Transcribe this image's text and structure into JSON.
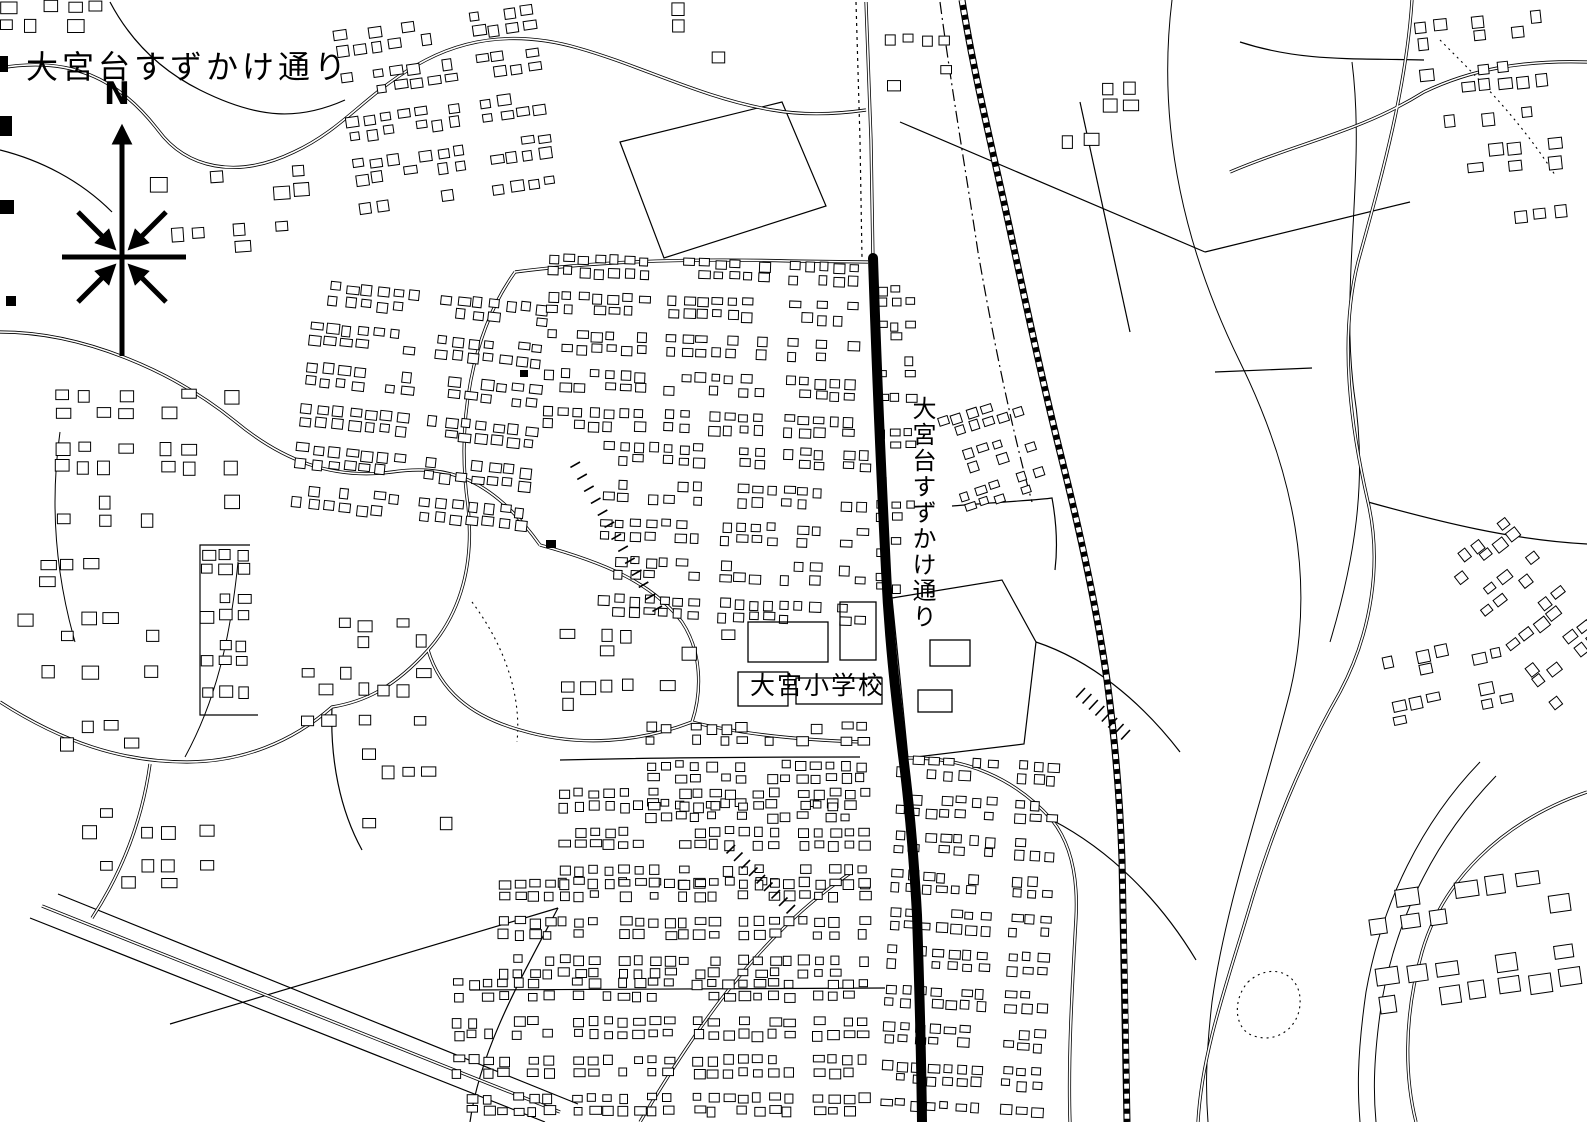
{
  "map": {
    "title": "大宮台すずかけ通り",
    "compass_label": "N",
    "road_label_vertical": "大宮台すずかけ通り",
    "school_label": "大宮小学校",
    "colors": {
      "ink": "#000000",
      "paper": "#ffffff",
      "highlight_road": "#000000"
    }
  }
}
